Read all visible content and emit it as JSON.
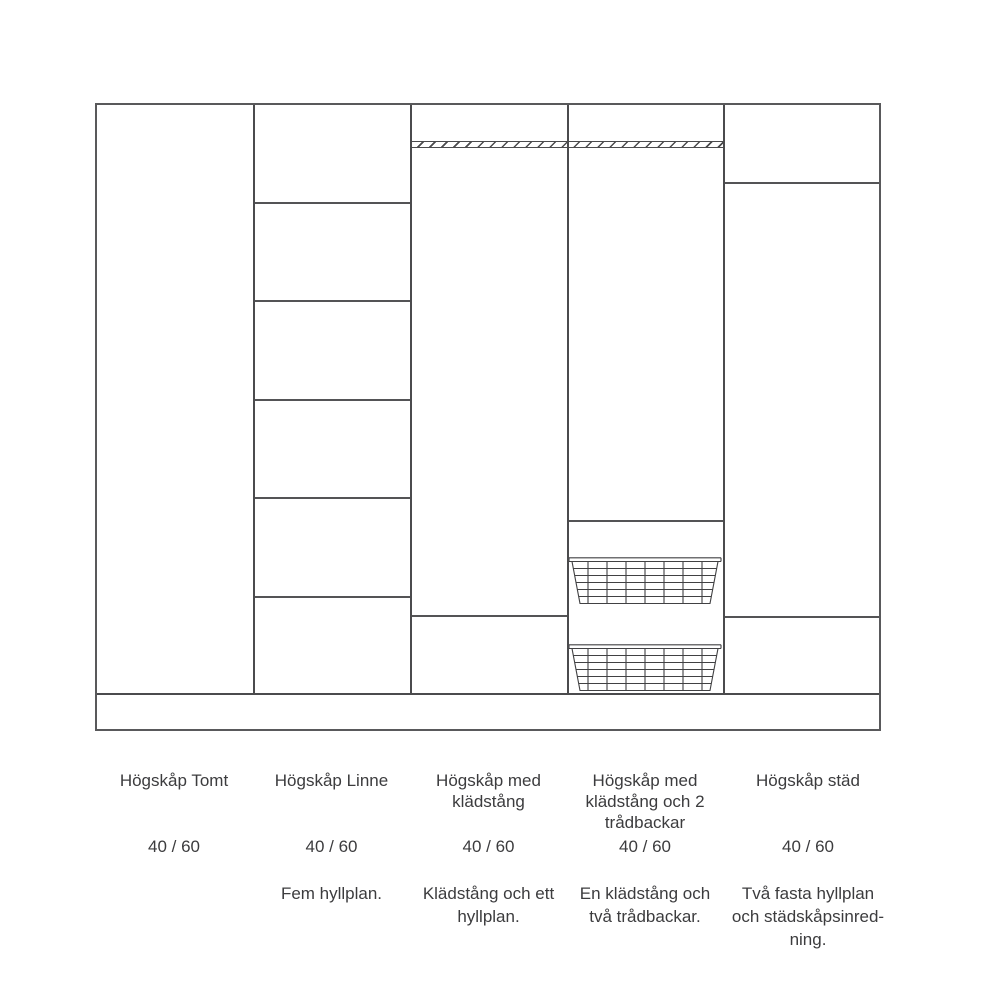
{
  "colors": {
    "line": "#4b4b4d",
    "outer_border": "#59595b",
    "text": "#3c3c3e",
    "background": "#ffffff"
  },
  "columns": [
    {
      "name": "Högskåp Tomt",
      "size": "40 / 60",
      "description": ""
    },
    {
      "name": "Högskåp Linne",
      "size": "40 / 60",
      "description": "Fem hyllplan."
    },
    {
      "name": "Högskåp med\nklädstång",
      "size": "40 / 60",
      "description": "Klädstång och ett\nhyllplan."
    },
    {
      "name": "Högskåp med\nklädstång och 2\ntrådbackar",
      "size": "40 / 60",
      "description": "En klädstång och\ntvå trådbackar."
    },
    {
      "name": "Högskåp städ",
      "size": "40 / 60",
      "description": "Två fasta hyllplan\noch städskåpsinred-\nning."
    }
  ]
}
